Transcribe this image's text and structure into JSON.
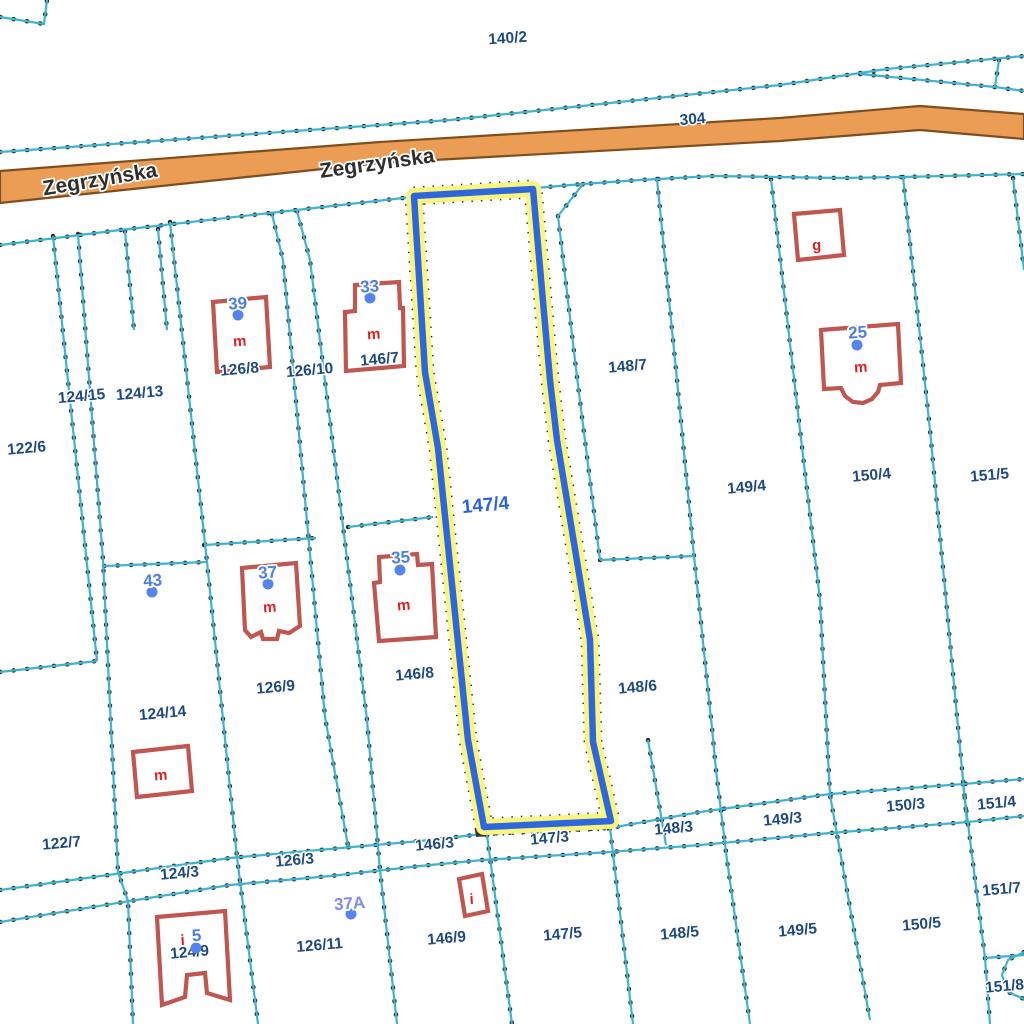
{
  "colors": {
    "background": "#ffffff",
    "boundary": "#3EB3CE",
    "boundary_dot": "#2b2b2b",
    "parcel_label": "#1E4A7F",
    "selected_label": "#2962E5",
    "address_label": "#4C7FE6",
    "address_label_alt": "#7F8BF0",
    "address_dot": "#5585EC",
    "building": "#C05650",
    "building_label": "#E21F1F",
    "road_fill": "#EC9D55",
    "road_border": "#7D4F1E",
    "road_label": "#2e2e2e",
    "highlight_halo": "#F9F57E",
    "highlight_line": "#2E66DC"
  },
  "road": {
    "polygon": [
      [
        0,
        171
      ],
      [
        380,
        142
      ],
      [
        780,
        118
      ],
      [
        920,
        106
      ],
      [
        1024,
        114
      ],
      [
        1024,
        139
      ],
      [
        920,
        130
      ],
      [
        780,
        141
      ],
      [
        380,
        163
      ],
      [
        0,
        203
      ]
    ],
    "labels": [
      {
        "text": "Zegrzyńska",
        "x": 101,
        "y": 186,
        "rot": -9.5,
        "size": 21
      },
      {
        "text": "Zegrzyńska",
        "x": 378,
        "y": 170,
        "rot": -8,
        "size": 21
      }
    ]
  },
  "boundaries": [
    {
      "id": "corner-top-left",
      "points": [
        [
          0,
          17
        ],
        [
          44,
          24
        ],
        [
          47,
          0
        ]
      ]
    },
    {
      "id": "north-of-road",
      "points": [
        [
          0,
          152
        ],
        [
          450,
          120
        ],
        [
          780,
          85
        ],
        [
          887,
          69
        ],
        [
          1024,
          56
        ]
      ]
    },
    {
      "id": "north-branch",
      "points": [
        [
          860,
          74
        ],
        [
          995,
          87
        ],
        [
          1024,
          91
        ]
      ]
    },
    {
      "id": "north-branch-tick",
      "points": [
        [
          995,
          87
        ],
        [
          999,
          60
        ]
      ]
    },
    {
      "id": "south-of-road",
      "points": [
        [
          0,
          245
        ],
        [
          120,
          230
        ],
        [
          270,
          213
        ],
        [
          412,
          197
        ],
        [
          535,
          188
        ],
        [
          583,
          184
        ],
        [
          640,
          180
        ],
        [
          713,
          176
        ],
        [
          840,
          178
        ],
        [
          903,
          177
        ],
        [
          1024,
          174
        ]
      ]
    },
    {
      "id": "w1",
      "points": [
        [
          53,
          236
        ],
        [
          97,
          661
        ]
      ]
    },
    {
      "id": "w2",
      "points": [
        [
          78,
          234
        ],
        [
          103,
          560
        ],
        [
          118,
          872
        ],
        [
          128,
          901
        ],
        [
          133,
          1024
        ]
      ]
    },
    {
      "id": "w3",
      "points": [
        [
          170,
          222
        ],
        [
          207,
          562
        ],
        [
          237,
          857
        ],
        [
          258,
          1024
        ]
      ]
    },
    {
      "id": "w-stub-a",
      "points": [
        [
          125,
          231
        ],
        [
          134,
          330
        ]
      ]
    },
    {
      "id": "w-stub-b",
      "points": [
        [
          158,
          229
        ],
        [
          167,
          330
        ]
      ]
    },
    {
      "id": "h-124-14-top",
      "points": [
        [
          104,
          566
        ],
        [
          207,
          562
        ]
      ]
    },
    {
      "id": "h-122-6-bottom",
      "points": [
        [
          0,
          672
        ],
        [
          97,
          661
        ]
      ]
    },
    {
      "id": "h-126-9-top",
      "points": [
        [
          204,
          545
        ],
        [
          316,
          538
        ]
      ]
    },
    {
      "id": "lane-west",
      "points": [
        [
          272,
          214
        ],
        [
          283,
          260
        ],
        [
          325,
          717
        ],
        [
          348,
          846
        ]
      ]
    },
    {
      "id": "lane-east",
      "points": [
        [
          297,
          211
        ],
        [
          310,
          260
        ],
        [
          367,
          720
        ],
        [
          380,
          870
        ],
        [
          397,
          1024
        ]
      ]
    },
    {
      "id": "h-146-8-top",
      "points": [
        [
          348,
          527
        ],
        [
          433,
          517
        ]
      ]
    },
    {
      "id": "e-147-jog",
      "points": [
        [
          583,
          184
        ],
        [
          558,
          216
        ],
        [
          577,
          377
        ],
        [
          600,
          560
        ]
      ]
    },
    {
      "id": "h-148-7-bottom",
      "points": [
        [
          600,
          560
        ],
        [
          694,
          556
        ]
      ]
    },
    {
      "id": "e-148",
      "points": [
        [
          657,
          179
        ],
        [
          677,
          380
        ],
        [
          694,
          556
        ],
        [
          712,
          728
        ],
        [
          716,
          770
        ],
        [
          727,
          860
        ],
        [
          750,
          1024
        ]
      ]
    },
    {
      "id": "e-149",
      "points": [
        [
          771,
          179
        ],
        [
          800,
          430
        ],
        [
          820,
          600
        ],
        [
          830,
          795
        ],
        [
          870,
          1020
        ]
      ]
    },
    {
      "id": "e-150",
      "points": [
        [
          903,
          177
        ],
        [
          930,
          430
        ],
        [
          967,
          822
        ]
      ]
    },
    {
      "id": "e-151",
      "points": [
        [
          1013,
          178
        ],
        [
          1024,
          270
        ]
      ]
    },
    {
      "id": "strip-upper",
      "points": [
        [
          0,
          890
        ],
        [
          130,
          872
        ],
        [
          230,
          858
        ],
        [
          330,
          849
        ],
        [
          420,
          841
        ],
        [
          483,
          834
        ],
        [
          610,
          828
        ],
        [
          700,
          812
        ],
        [
          830,
          794
        ],
        [
          963,
          784
        ],
        [
          1024,
          779
        ]
      ]
    },
    {
      "id": "strip-lower",
      "points": [
        [
          0,
          922
        ],
        [
          130,
          901
        ],
        [
          230,
          885
        ],
        [
          330,
          876
        ],
        [
          420,
          866
        ],
        [
          483,
          860
        ],
        [
          610,
          852
        ],
        [
          700,
          845
        ],
        [
          830,
          833
        ],
        [
          968,
          822
        ],
        [
          1024,
          816
        ]
      ]
    },
    {
      "id": "x-148-3",
      "points": [
        [
          648,
          740
        ],
        [
          666,
          845
        ]
      ]
    },
    {
      "id": "s-146-9",
      "points": [
        [
          487,
          835
        ],
        [
          512,
          1024
        ]
      ]
    },
    {
      "id": "s-147-5",
      "points": [
        [
          610,
          828
        ],
        [
          633,
          1024
        ]
      ]
    },
    {
      "id": "s-151",
      "points": [
        [
          963,
          784
        ],
        [
          985,
          958
        ],
        [
          990,
          1024
        ]
      ]
    },
    {
      "id": "s-151-nook",
      "points": [
        [
          985,
          958
        ],
        [
          1024,
          955
        ]
      ]
    },
    {
      "id": "s-151-arc",
      "points": [
        [
          1024,
          952
        ],
        [
          1008,
          960
        ],
        [
          1002,
          975
        ],
        [
          1008,
          992
        ],
        [
          1024,
          999
        ]
      ]
    }
  ],
  "selected_parcel": {
    "label": {
      "text": "147/4",
      "x": 486,
      "y": 511,
      "rot": -5,
      "size": 19
    },
    "polygon": [
      [
        414,
        196
      ],
      [
        533,
        189
      ],
      [
        550,
        380
      ],
      [
        557,
        440
      ],
      [
        590,
        640
      ],
      [
        593,
        742
      ],
      [
        611,
        821
      ],
      [
        484,
        827
      ],
      [
        468,
        740
      ],
      [
        438,
        448
      ],
      [
        425,
        372
      ]
    ]
  },
  "parcel_labels": [
    {
      "text": "140/2",
      "x": 508,
      "y": 43,
      "rot": -4
    },
    {
      "text": "304",
      "x": 693,
      "y": 124,
      "rot": -5
    },
    {
      "text": "122/6",
      "x": 27,
      "y": 453,
      "rot": -5
    },
    {
      "text": "124/15",
      "x": 82,
      "y": 401,
      "rot": -5
    },
    {
      "text": "124/13",
      "x": 140,
      "y": 398,
      "rot": -5
    },
    {
      "text": "126/8",
      "x": 240,
      "y": 374,
      "rot": -5
    },
    {
      "text": "126/10",
      "x": 310,
      "y": 375,
      "rot": -5
    },
    {
      "text": "146/7",
      "x": 380,
      "y": 364,
      "rot": -5
    },
    {
      "text": "148/7",
      "x": 628,
      "y": 371,
      "rot": -5
    },
    {
      "text": "149/4",
      "x": 747,
      "y": 492,
      "rot": -5
    },
    {
      "text": "150/4",
      "x": 872,
      "y": 480,
      "rot": -5
    },
    {
      "text": "151/5",
      "x": 990,
      "y": 480,
      "rot": -5
    },
    {
      "text": "126/9",
      "x": 276,
      "y": 692,
      "rot": -5
    },
    {
      "text": "146/8",
      "x": 415,
      "y": 679,
      "rot": -5
    },
    {
      "text": "148/6",
      "x": 638,
      "y": 692,
      "rot": -5
    },
    {
      "text": "124/14",
      "x": 163,
      "y": 718,
      "rot": -5
    },
    {
      "text": "122/7",
      "x": 62,
      "y": 848,
      "rot": -5
    },
    {
      "text": "124/3",
      "x": 180,
      "y": 878,
      "rot": -5
    },
    {
      "text": "126/3",
      "x": 295,
      "y": 865,
      "rot": -5
    },
    {
      "text": "146/3",
      "x": 435,
      "y": 849,
      "rot": -5
    },
    {
      "text": "147/3",
      "x": 550,
      "y": 843,
      "rot": -5
    },
    {
      "text": "148/3",
      "x": 674,
      "y": 833,
      "rot": -5
    },
    {
      "text": "149/3",
      "x": 783,
      "y": 824,
      "rot": -5
    },
    {
      "text": "150/3",
      "x": 906,
      "y": 810,
      "rot": -5
    },
    {
      "text": "151/4",
      "x": 997,
      "y": 808,
      "rot": -5
    },
    {
      "text": "151/7",
      "x": 1002,
      "y": 894,
      "rot": -5
    },
    {
      "text": "151/8",
      "x": 1005,
      "y": 991,
      "rot": -5
    },
    {
      "text": "126/11",
      "x": 320,
      "y": 950,
      "rot": -5
    },
    {
      "text": "146/9",
      "x": 447,
      "y": 943,
      "rot": -5
    },
    {
      "text": "147/5",
      "x": 563,
      "y": 939,
      "rot": -5
    },
    {
      "text": "148/5",
      "x": 680,
      "y": 938,
      "rot": -5
    },
    {
      "text": "149/5",
      "x": 798,
      "y": 935,
      "rot": -5
    },
    {
      "text": "150/5",
      "x": 922,
      "y": 929,
      "rot": -5
    },
    {
      "text": "124/9",
      "x": 190,
      "y": 957,
      "rot": -5
    }
  ],
  "buildings": [
    {
      "id": "39",
      "points": [
        [
          213,
          302
        ],
        [
          266,
          297
        ],
        [
          270,
          367
        ],
        [
          217,
          372
        ]
      ],
      "label": {
        "text": "m",
        "x": 240,
        "y": 346
      }
    },
    {
      "id": "33",
      "points": [
        [
          355,
          285
        ],
        [
          399,
          282
        ],
        [
          400,
          308
        ],
        [
          403,
          308
        ],
        [
          404,
          366
        ],
        [
          346,
          371
        ],
        [
          345,
          312
        ],
        [
          355,
          311
        ]
      ],
      "label": {
        "text": "m",
        "x": 374,
        "y": 339
      }
    },
    {
      "id": "g",
      "points": [
        [
          794,
          214
        ],
        [
          840,
          210
        ],
        [
          844,
          255
        ],
        [
          798,
          260
        ]
      ],
      "label": {
        "text": "g",
        "x": 817,
        "y": 250
      }
    },
    {
      "id": "25",
      "points": [
        [
          821,
          330
        ],
        [
          898,
          324
        ],
        [
          901,
          383
        ],
        [
          880,
          385
        ],
        [
          878,
          392
        ],
        [
          872,
          399
        ],
        [
          863,
          403
        ],
        [
          853,
          402
        ],
        [
          845,
          396
        ],
        [
          841,
          388
        ],
        [
          824,
          389
        ]
      ],
      "label": {
        "text": "m",
        "x": 861,
        "y": 372
      }
    },
    {
      "id": "37",
      "points": [
        [
          242,
          568
        ],
        [
          296,
          563
        ],
        [
          300,
          626
        ],
        [
          289,
          633
        ],
        [
          279,
          631
        ],
        [
          277,
          639
        ],
        [
          263,
          639
        ],
        [
          261,
          632
        ],
        [
          251,
          637
        ],
        [
          245,
          630
        ]
      ],
      "label": {
        "text": "m",
        "x": 270,
        "y": 612
      }
    },
    {
      "id": "35",
      "points": [
        [
          379,
          557
        ],
        [
          417,
          554
        ],
        [
          418,
          565
        ],
        [
          432,
          564
        ],
        [
          436,
          637
        ],
        [
          379,
          641
        ],
        [
          374,
          583
        ],
        [
          380,
          582
        ]
      ],
      "label": {
        "text": "m",
        "x": 404,
        "y": 610
      }
    },
    {
      "id": "m-124-14",
      "points": [
        [
          133,
          752
        ],
        [
          188,
          746
        ],
        [
          192,
          791
        ],
        [
          137,
          797
        ]
      ],
      "label": {
        "text": "m",
        "x": 161,
        "y": 780
      }
    },
    {
      "id": "5",
      "points": [
        [
          157,
          917
        ],
        [
          225,
          911
        ],
        [
          230,
          1000
        ],
        [
          207,
          993
        ],
        [
          205,
          973
        ],
        [
          187,
          975
        ],
        [
          185,
          997
        ],
        [
          162,
          1005
        ]
      ],
      "label": {
        "text": "i",
        "x": 183,
        "y": 945
      }
    },
    {
      "id": "i-146-9",
      "points": [
        [
          459,
          879
        ],
        [
          482,
          874
        ],
        [
          488,
          911
        ],
        [
          465,
          916
        ]
      ],
      "label": {
        "text": "i",
        "x": 472,
        "y": 904
      }
    }
  ],
  "address_markers": [
    {
      "text": "39",
      "x": 238,
      "y": 309,
      "dot": [
        238,
        315
      ],
      "alt": false
    },
    {
      "text": "33",
      "x": 370,
      "y": 292,
      "dot": [
        370,
        298
      ],
      "alt": false
    },
    {
      "text": "25",
      "x": 858,
      "y": 338,
      "dot": [
        857,
        345
      ],
      "alt": false
    },
    {
      "text": "43",
      "x": 153,
      "y": 586,
      "dot": [
        152,
        592
      ],
      "alt": false
    },
    {
      "text": "37",
      "x": 268,
      "y": 578,
      "dot": [
        268,
        584
      ],
      "alt": false
    },
    {
      "text": "35",
      "x": 401,
      "y": 563,
      "dot": [
        400,
        570
      ],
      "alt": false
    },
    {
      "text": "5",
      "x": 197,
      "y": 941,
      "dot": [
        196,
        948
      ],
      "alt": false
    },
    {
      "text": "37A",
      "x": 350,
      "y": 909,
      "dot": [
        351,
        914
      ],
      "alt": true
    }
  ]
}
